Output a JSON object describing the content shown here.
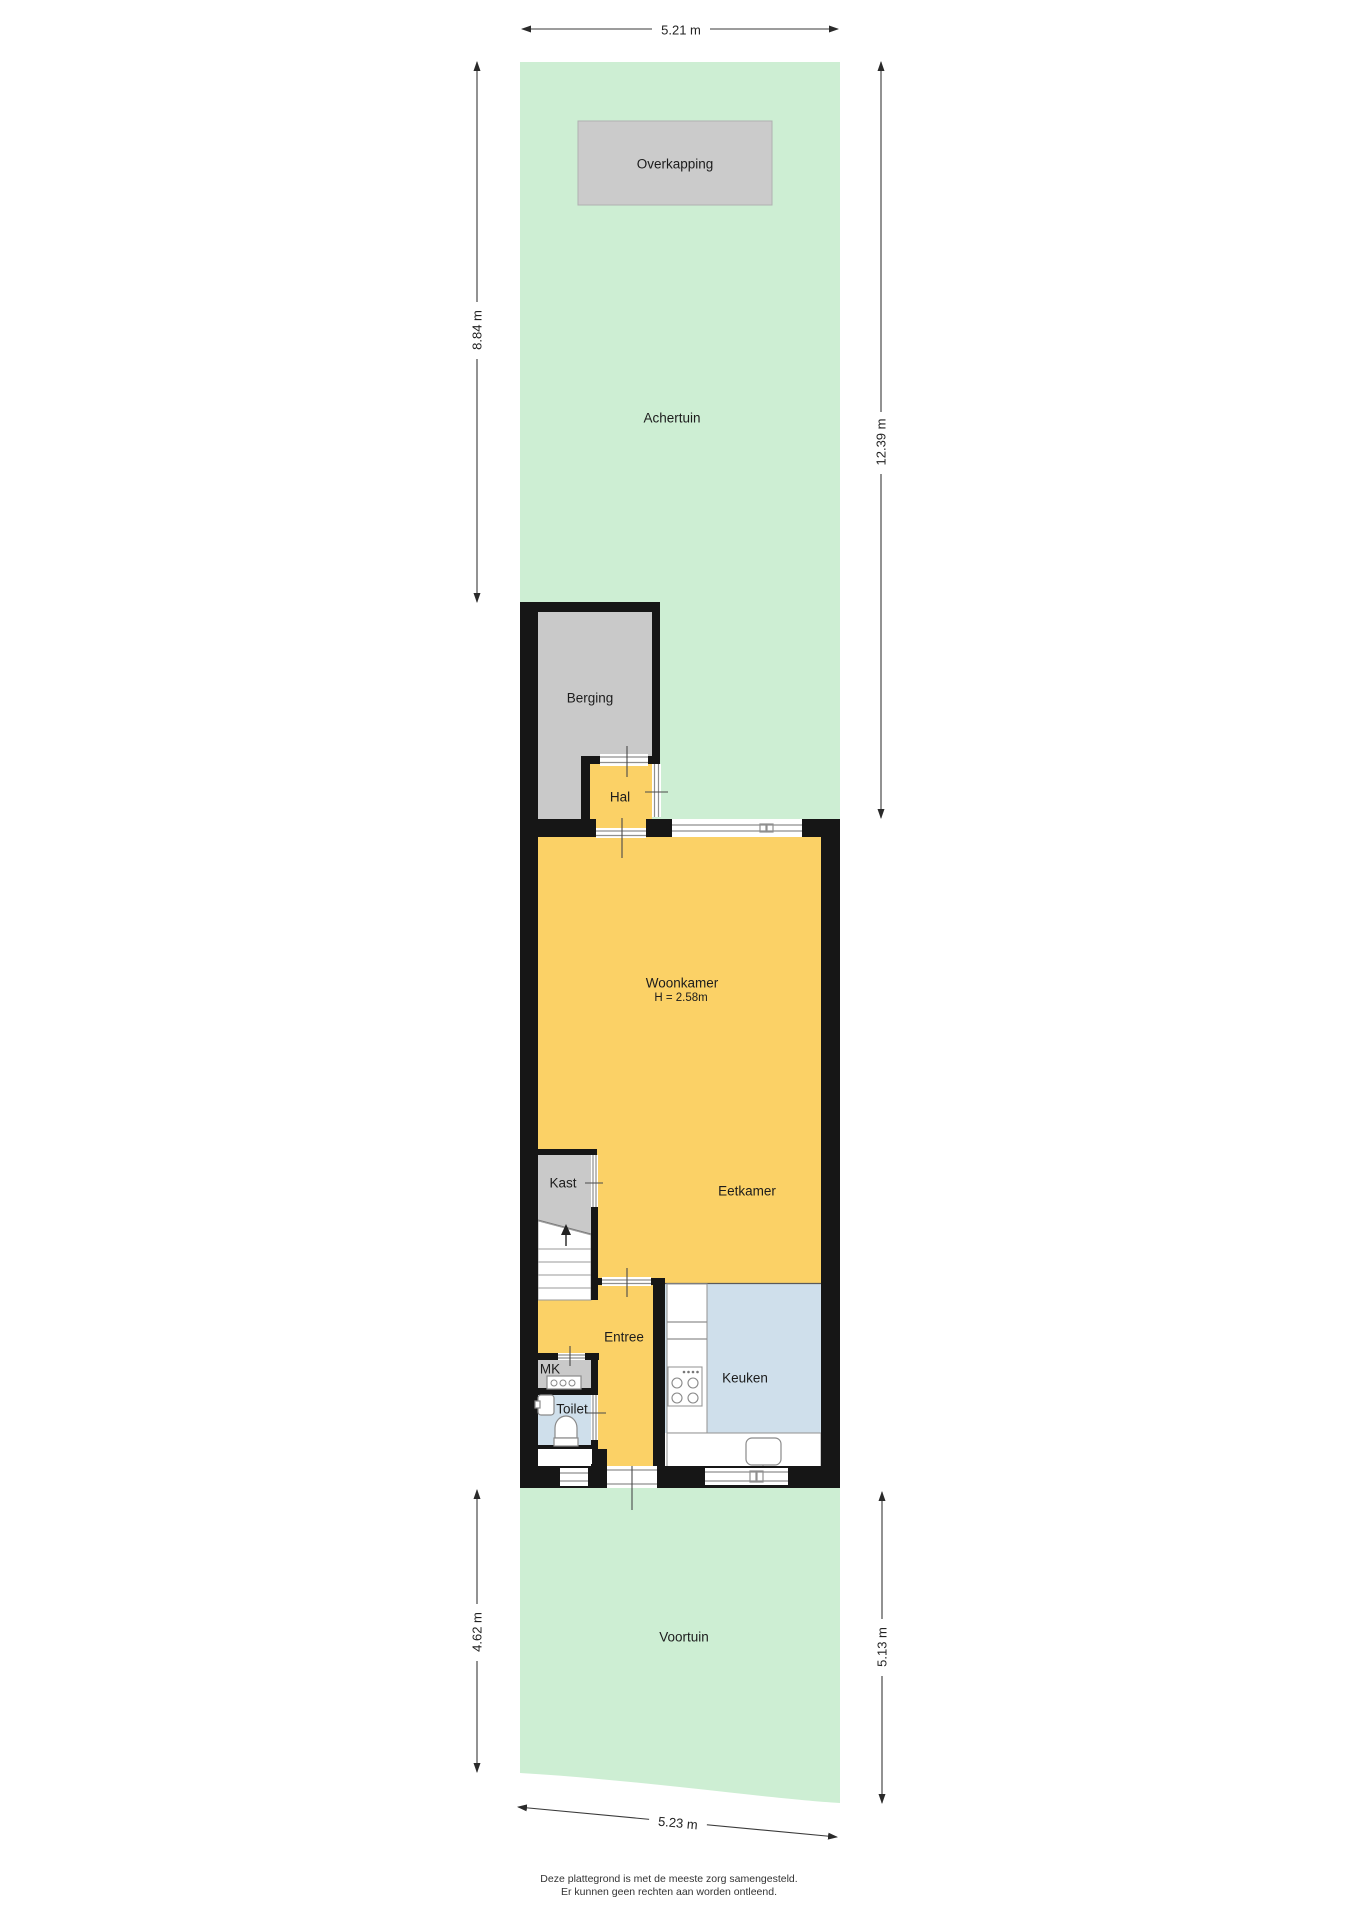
{
  "rooms": {
    "overkapping": "Overkapping",
    "achtertuin": "Achertuin",
    "berging": "Berging",
    "hal": "Hal",
    "woonkamer": "Woonkamer",
    "woonkamer_height": "H = 2.58m",
    "kast": "Kast",
    "eetkamer": "Eetkamer",
    "entree": "Entree",
    "mk": "MK",
    "toilet": "Toilet",
    "keuken": "Keuken",
    "voortuin": "Voortuin"
  },
  "dimensions": {
    "top_width": "5.21 m",
    "back_garden_height": "8.84 m",
    "right_total_height": "12.39 m",
    "front_garden_height_left": "4.62 m",
    "front_garden_height_right": "5.13 m",
    "bottom_width": "5.23 m"
  },
  "footer": {
    "line1": "Deze plattegrond is met de meeste zorg samengesteld.",
    "line2": "Er kunnen geen rechten aan worden ontleend."
  },
  "colors": {
    "garden": "#cdeed3",
    "floor_yellow": "#fbd166",
    "floor_blue": "#cfdfeb",
    "floor_gray": "#c9c9c9",
    "canopy_gray": "#cbcbcb",
    "wall": "#161616"
  }
}
